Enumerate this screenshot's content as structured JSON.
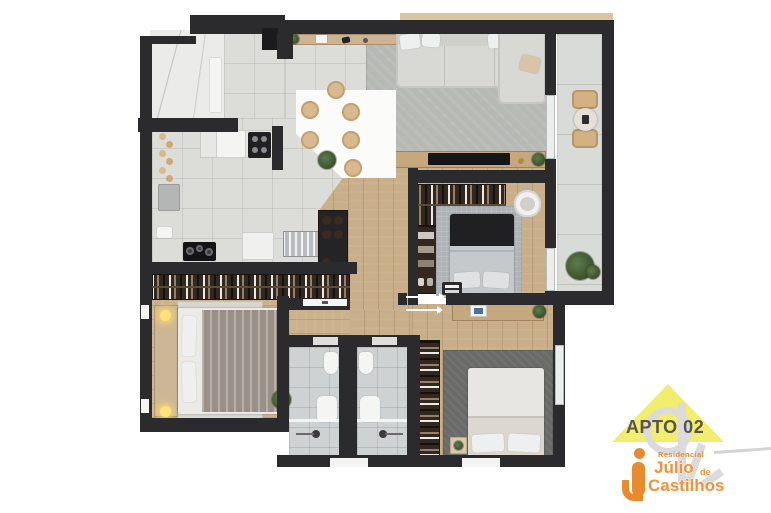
{
  "logo": {
    "unit": "APTO 02",
    "residencial": "Residencial",
    "name_first": "Júlio",
    "name_connector": "de",
    "name_last": "Castilhos"
  },
  "colors": {
    "accent_orange": "#ee8d35",
    "roof_yellow": "#f1ed6f",
    "apto_text": "#5a534e",
    "wall_dark": "#2b2b2e",
    "wood_floor": "#c8ae89",
    "tile_floor": "#dcddd9",
    "dark_wood_furniture": "#32281f",
    "sofa_gray": "#d8d8d5",
    "watermark_gray": "#dbdbdb"
  }
}
